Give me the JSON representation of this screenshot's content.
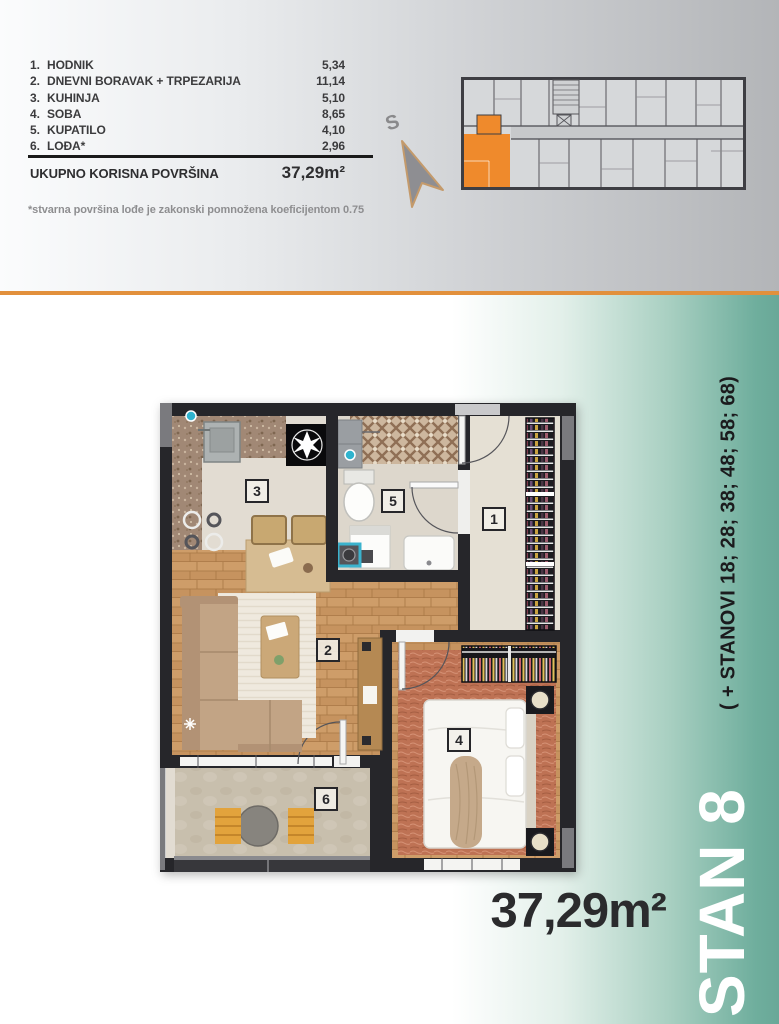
{
  "colors": {
    "accent_orange": "#E2903C",
    "unit_highlight_orange": "#EF8A2C",
    "teal": "#6FAE9D",
    "wall_dark": "#26262A"
  },
  "header": {
    "rooms": [
      {
        "num": "1.",
        "label": "HODNIK",
        "area": "5,34"
      },
      {
        "num": "2.",
        "label": "DNEVNI BORAVAK + TRPEZARIJA",
        "area": "11,14"
      },
      {
        "num": "3.",
        "label": "KUHINJA",
        "area": "5,10"
      },
      {
        "num": "4.",
        "label": "SOBA",
        "area": "8,65"
      },
      {
        "num": "5.",
        "label": "KUPATILO",
        "area": "4,10"
      },
      {
        "num": "6.",
        "label": "LOĐA*",
        "area": "2,96"
      }
    ],
    "total_label": "UKUPNO KORISNA POVRŠINA",
    "total_value": "37,29m²",
    "footnote": "*stvarna površina lođe je zakonski pomnožena koeficijentom 0.75",
    "compass": "S"
  },
  "plan": {
    "room_numbers": {
      "hodnik": "1",
      "dnevni_boravak": "2",
      "kuhinja": "3",
      "soba": "4",
      "kupatilo": "5",
      "lodja": "6"
    }
  },
  "footer": {
    "unit_name": "STAN 8",
    "related_units": "( + STANOVI 18; 28; 38; 48; 58; 68)",
    "area": "37,29m²"
  }
}
